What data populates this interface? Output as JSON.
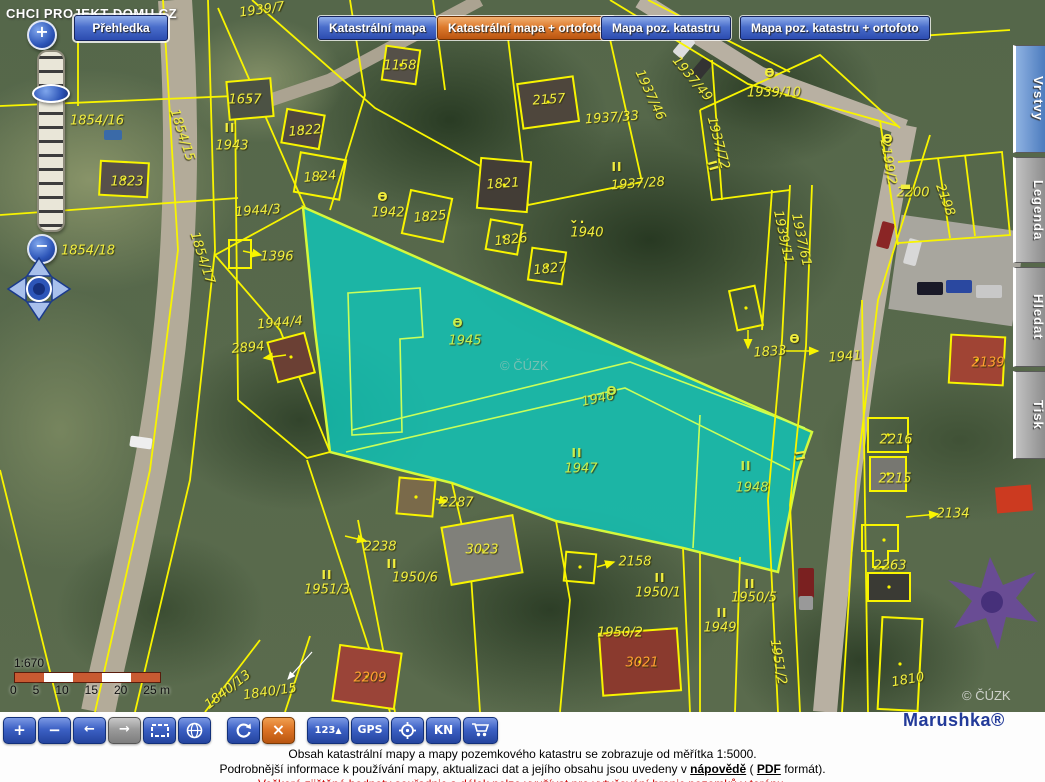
{
  "site": {
    "overlay_text": "CHCI PROJEKT DOMU.CZ"
  },
  "top": {
    "overview_button": "Přehledka",
    "map_type_buttons": [
      {
        "label": "Katastrální mapa",
        "active": false
      },
      {
        "label": "Katastrální mapa + ortofoto",
        "active": true
      },
      {
        "label": "Mapa poz. katastru",
        "active": false
      },
      {
        "label": "Mapa poz. katastru + ortofoto",
        "active": false
      }
    ]
  },
  "side_tabs": [
    {
      "label": "Vrstvy",
      "active": true
    },
    {
      "label": "Legenda",
      "active": false
    },
    {
      "label": "Hledat",
      "active": false
    },
    {
      "label": "Tisk",
      "active": false
    }
  ],
  "left_controls": {
    "zoom_in": "+",
    "zoom_out": "−"
  },
  "toolbar": {
    "zoom_in": "+",
    "zoom_out": "−",
    "back": "←",
    "forward": "→",
    "cancel": "×",
    "measure": "123",
    "measure_arrow": "▲",
    "gps": "GPS",
    "kn": "KN"
  },
  "scalebar": {
    "ratio": "1:670",
    "tick_labels": [
      "0",
      "5",
      "10",
      "15",
      "20",
      "25 m"
    ]
  },
  "watermark_center": "© ČÚZK",
  "watermark_corner": "© ČÚZK",
  "brand": "Marushka®",
  "footer": {
    "line1": "Obsah katastrální mapy a mapy pozemkového katastru se zobrazuje od měřítka 1:5000.",
    "line2_pre": "Podrobnější informace k používání mapy, aktualizaci dat a jejího obsahu jsou uvedeny v",
    "link_help": "nápovědě",
    "line2_mid": "(",
    "link_pdf": "PDF",
    "line2_post": "formát).",
    "line3": "Veškeré zjištěné hodnoty souřadnic a délek nelze využívat pro vytyčování hranic pozemků v terénu."
  },
  "map": {
    "selection_parcels": [
      "1945",
      "1946",
      "1947",
      "1948"
    ],
    "symbol_glyphs": {
      "church": "Ɵ",
      "land-class": "II",
      "meadow": "⌄.",
      "dash": "▬"
    },
    "labels": [
      {
        "t": "1939/7",
        "x": 262,
        "y": 10,
        "r": -8
      },
      {
        "t": "1937/32",
        "x": 617,
        "y": 33,
        "r": -6
      },
      {
        "t": "1158",
        "x": 400,
        "y": 66
      },
      {
        "t": "1657",
        "x": 245,
        "y": 100
      },
      {
        "t": "2157",
        "x": 549,
        "y": 100,
        "r": -4
      },
      {
        "t": "1937/46",
        "x": 650,
        "y": 95,
        "r": 65
      },
      {
        "t": "1937/49",
        "x": 692,
        "y": 79,
        "r": 50
      },
      {
        "t": "1939/10",
        "x": 774,
        "y": 93
      },
      {
        "t": "1937/33",
        "x": 612,
        "y": 118,
        "r": -4
      },
      {
        "t": "1854/16",
        "x": 97,
        "y": 121
      },
      {
        "t": "1822",
        "x": 305,
        "y": 131,
        "r": -5
      },
      {
        "t": "1937/72",
        "x": 718,
        "y": 143,
        "r": 75
      },
      {
        "t": "1943",
        "x": 232,
        "y": 146
      },
      {
        "t": "2199/2",
        "x": 888,
        "y": 162,
        "r": 80
      },
      {
        "t": "1854/15",
        "x": 182,
        "y": 135,
        "r": 72
      },
      {
        "t": "1823",
        "x": 127,
        "y": 182
      },
      {
        "t": "1824",
        "x": 320,
        "y": 177,
        "r": -5
      },
      {
        "t": "1821",
        "x": 503,
        "y": 184,
        "r": -4
      },
      {
        "t": "1937/28",
        "x": 638,
        "y": 184,
        "r": -4
      },
      {
        "t": "2200",
        "x": 913,
        "y": 193
      },
      {
        "t": "2198",
        "x": 945,
        "y": 200,
        "r": 70
      },
      {
        "t": "1944/3",
        "x": 258,
        "y": 211,
        "r": -4
      },
      {
        "t": "1942",
        "x": 388,
        "y": 213
      },
      {
        "t": "1825",
        "x": 430,
        "y": 217,
        "r": -5
      },
      {
        "t": "1940",
        "x": 587,
        "y": 233
      },
      {
        "t": "1826",
        "x": 511,
        "y": 240,
        "r": -6
      },
      {
        "t": "1854/18",
        "x": 88,
        "y": 251
      },
      {
        "t": "1396",
        "x": 277,
        "y": 257
      },
      {
        "t": "1827",
        "x": 550,
        "y": 269,
        "r": -6
      },
      {
        "t": "1939/11",
        "x": 783,
        "y": 237,
        "r": 78
      },
      {
        "t": "1937/61",
        "x": 801,
        "y": 240,
        "r": 78
      },
      {
        "t": "1854/17",
        "x": 202,
        "y": 258,
        "r": 72
      },
      {
        "t": "1944/4",
        "x": 280,
        "y": 323,
        "r": -5
      },
      {
        "t": "2894",
        "x": 248,
        "y": 348,
        "r": -5
      },
      {
        "t": "1945",
        "x": 465,
        "y": 341,
        "c": "g"
      },
      {
        "t": "1833",
        "x": 770,
        "y": 352,
        "r": -4
      },
      {
        "t": "1941",
        "x": 845,
        "y": 357,
        "r": -4
      },
      {
        "t": "2139",
        "x": 988,
        "y": 363,
        "c": "o"
      },
      {
        "t": "1946",
        "x": 598,
        "y": 399,
        "r": -12,
        "c": "g"
      },
      {
        "t": "2216",
        "x": 896,
        "y": 440
      },
      {
        "t": "1947",
        "x": 581,
        "y": 469,
        "c": "g"
      },
      {
        "t": "2215",
        "x": 895,
        "y": 479
      },
      {
        "t": "1948",
        "x": 752,
        "y": 488,
        "c": "g"
      },
      {
        "t": "2287",
        "x": 457,
        "y": 503
      },
      {
        "t": "2134",
        "x": 953,
        "y": 514
      },
      {
        "t": "2238",
        "x": 380,
        "y": 547
      },
      {
        "t": "3023",
        "x": 482,
        "y": 550
      },
      {
        "t": "2158",
        "x": 635,
        "y": 562
      },
      {
        "t": "2263",
        "x": 890,
        "y": 566
      },
      {
        "t": "1950/6",
        "x": 415,
        "y": 578
      },
      {
        "t": "1951/3",
        "x": 327,
        "y": 590
      },
      {
        "t": "1950/1",
        "x": 658,
        "y": 593
      },
      {
        "t": "1950/5",
        "x": 754,
        "y": 598
      },
      {
        "t": "1949",
        "x": 720,
        "y": 628
      },
      {
        "t": "1950/2",
        "x": 620,
        "y": 633
      },
      {
        "t": "1951/2",
        "x": 778,
        "y": 662,
        "r": 80
      },
      {
        "t": "3021",
        "x": 642,
        "y": 663,
        "c": "o"
      },
      {
        "t": "2209",
        "x": 370,
        "y": 678,
        "c": "o"
      },
      {
        "t": "1840/13",
        "x": 228,
        "y": 690,
        "r": -38
      },
      {
        "t": "1840/15",
        "x": 270,
        "y": 692,
        "r": -8
      },
      {
        "t": "1810",
        "x": 908,
        "y": 680,
        "r": -10
      }
    ],
    "symbols": [
      {
        "g": "church",
        "x": 383,
        "y": 197
      },
      {
        "g": "church",
        "x": 770,
        "y": 73
      },
      {
        "g": "church",
        "x": 888,
        "y": 139
      },
      {
        "g": "church",
        "x": 795,
        "y": 339
      },
      {
        "g": "church",
        "x": 458,
        "y": 323,
        "c": "g"
      },
      {
        "g": "church",
        "x": 612,
        "y": 391,
        "c": "g"
      },
      {
        "g": "land-class",
        "x": 230,
        "y": 128
      },
      {
        "g": "land-class",
        "x": 617,
        "y": 167
      },
      {
        "g": "land-class",
        "x": 713,
        "y": 166,
        "r": 75
      },
      {
        "g": "land-class",
        "x": 800,
        "y": 456,
        "r": 80
      },
      {
        "g": "land-class",
        "x": 577,
        "y": 453,
        "c": "g"
      },
      {
        "g": "land-class",
        "x": 746,
        "y": 466,
        "c": "g"
      },
      {
        "g": "land-class",
        "x": 392,
        "y": 564
      },
      {
        "g": "land-class",
        "x": 327,
        "y": 575
      },
      {
        "g": "land-class",
        "x": 660,
        "y": 578
      },
      {
        "g": "land-class",
        "x": 750,
        "y": 584
      },
      {
        "g": "land-class",
        "x": 722,
        "y": 613
      },
      {
        "g": "meadow",
        "x": 577,
        "y": 219
      },
      {
        "g": "dash",
        "x": 906,
        "y": 186
      }
    ]
  }
}
